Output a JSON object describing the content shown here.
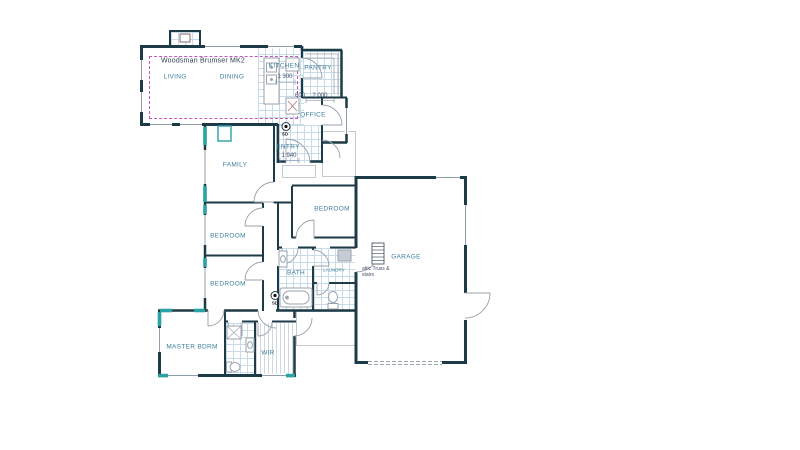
{
  "plan": {
    "title": "Woodsman Brumser MK2",
    "rooms": {
      "living": "LIVING",
      "dining": "DINING",
      "kitchen": "KITCHEN",
      "pantry": "PANTRY",
      "office": "OFFICE",
      "entry": "ENTRY",
      "family": "FAMILY",
      "bedroom_right": "BEDROOM",
      "bedroom_mid": "BEDROOM",
      "bedroom_lower": "BEDROOM",
      "bath": "BATH",
      "laundry": "LAUNDRY",
      "garage": "GARAGE",
      "master": "MASTER BDRM",
      "wir": "WIR"
    },
    "dimensions": {
      "kitchen_island": "1 300",
      "kitchen_clearance": "600",
      "pantry_width": "2 000",
      "entry_width": "1 940"
    },
    "annotations": {
      "attic_line1": "attic Truss &",
      "attic_line2": "stairs",
      "smoke_detector": "SD"
    },
    "colors": {
      "wall": "#1d3a47",
      "window_teal": "#2aa3a5",
      "ceiling_dashed": "#c257bd",
      "room_label": "#3f7e9b",
      "title_text": "#2e3e55",
      "tile_line": "#c2d8e6",
      "dimension_text": "#3f4f6a"
    }
  }
}
